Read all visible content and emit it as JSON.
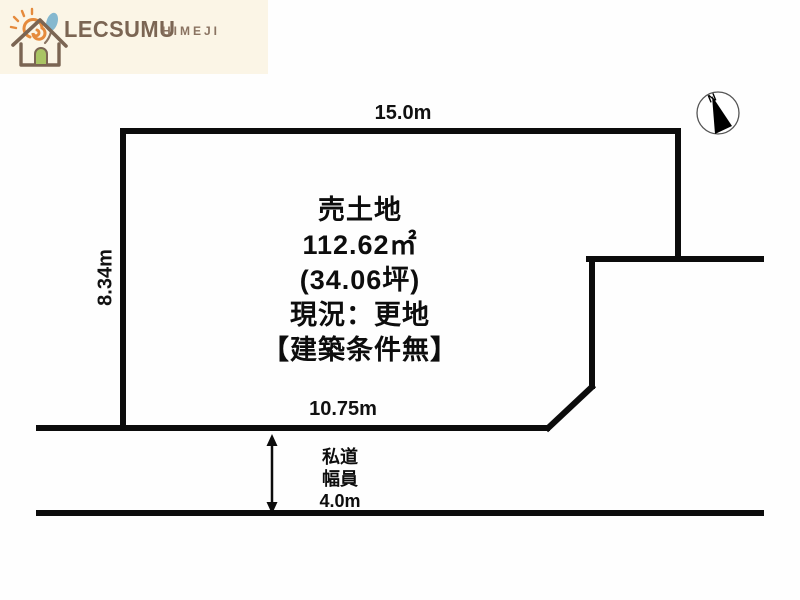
{
  "logo": {
    "brand": "LECSUMU",
    "location": "HIMEJI",
    "icon": "house-logo-icon",
    "colors": {
      "background": "#fbf5e6",
      "brand_brown": "#7b6553",
      "sub_brown": "#8a7361",
      "sun_orange": "#e58a3c",
      "leaf_blue": "#85b8cf",
      "door_green": "#a9c464"
    }
  },
  "compass": {
    "north_label": "N"
  },
  "dimensions": {
    "top_edge": "15.0m",
    "left_edge": "8.34m",
    "bottom_edge": "10.75m"
  },
  "parcel": {
    "lines": [
      "売土地",
      "112.62㎡",
      "(34.06坪)",
      "現況：更地",
      "【建築条件無】"
    ]
  },
  "road": {
    "lines": [
      "私道",
      "幅員",
      "4.0m"
    ]
  },
  "diagram_colors": {
    "outline": "#0c0c0c",
    "canvas": "#fefefe"
  }
}
